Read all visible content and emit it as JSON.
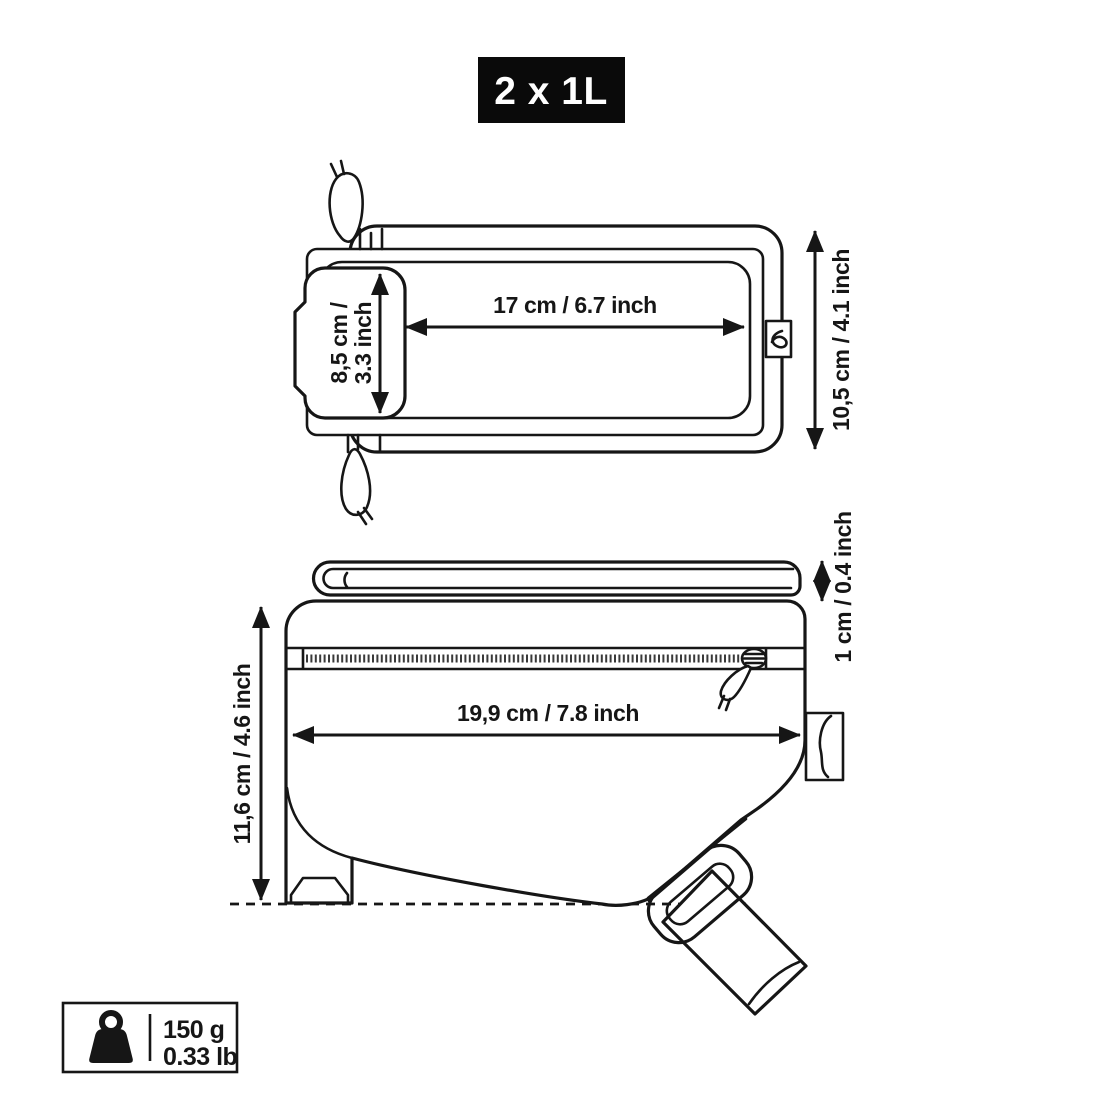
{
  "badge": {
    "label": "2 x 1L"
  },
  "top_view": {
    "width_label": "17 cm / 6.7 inch",
    "window_height_line1": "8,5 cm /",
    "window_height_line2": "3.3 inch",
    "height_label": "10,5 cm / 4.1 inch"
  },
  "side_view": {
    "flap_height_label": "1 cm / 0.4 inch",
    "width_label": "19,9 cm / 7.8 inch",
    "height_label": "11,6 cm / 4.6 inch"
  },
  "weight_badge": {
    "metric": "150 g",
    "imperial": "0.33 lb"
  },
  "colors": {
    "ink": "#161616",
    "badge_background": "#0a0a0a",
    "badge_text": "#ffffff",
    "background": "#ffffff"
  }
}
